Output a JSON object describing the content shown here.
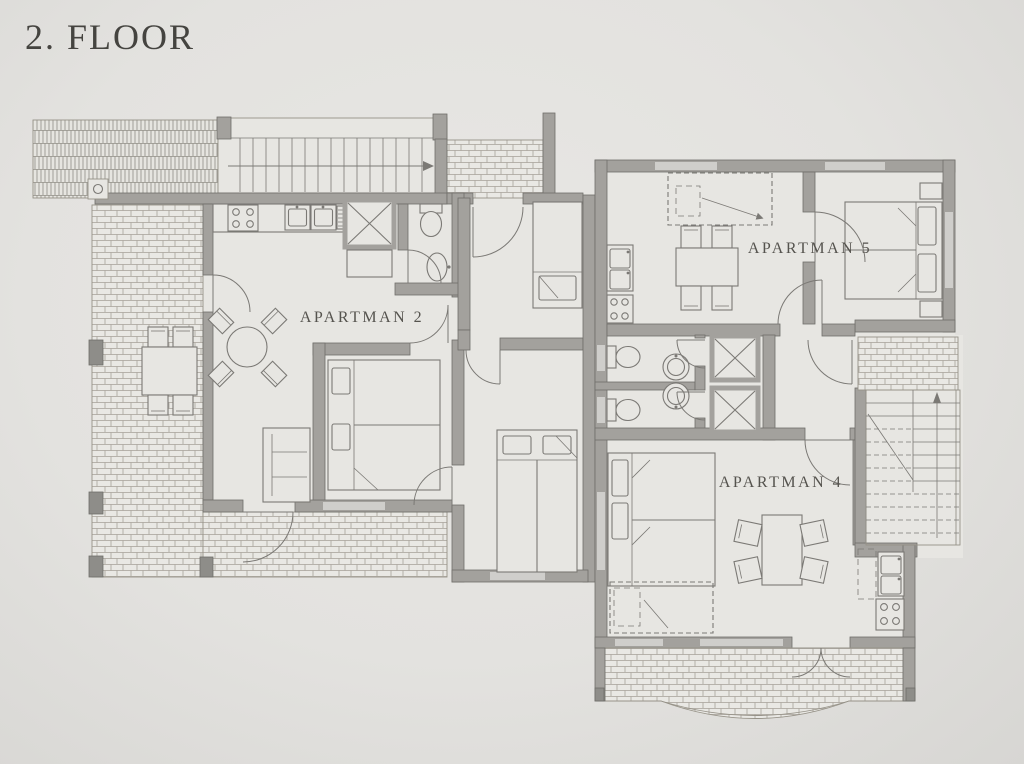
{
  "title": "2. FLOOR",
  "labels": {
    "apartment2": "APARTMAN 2",
    "apartment5": "APARTMAN 5",
    "apartment4": "APARTMAN 4"
  },
  "colors": {
    "paper": "#e3e2df",
    "paper-light": "#e8e7e4",
    "paper-dark": "#d7d6d3",
    "room": "#e7e6e2",
    "wall": "#a3a19d",
    "wall-dark": "#8e8d89",
    "wall-stroke": "#6f6e6a",
    "edge": "#969288",
    "line": "#7b7975",
    "window": "#cfcecb",
    "text": "#55534e",
    "text-dark": "#454440"
  }
}
